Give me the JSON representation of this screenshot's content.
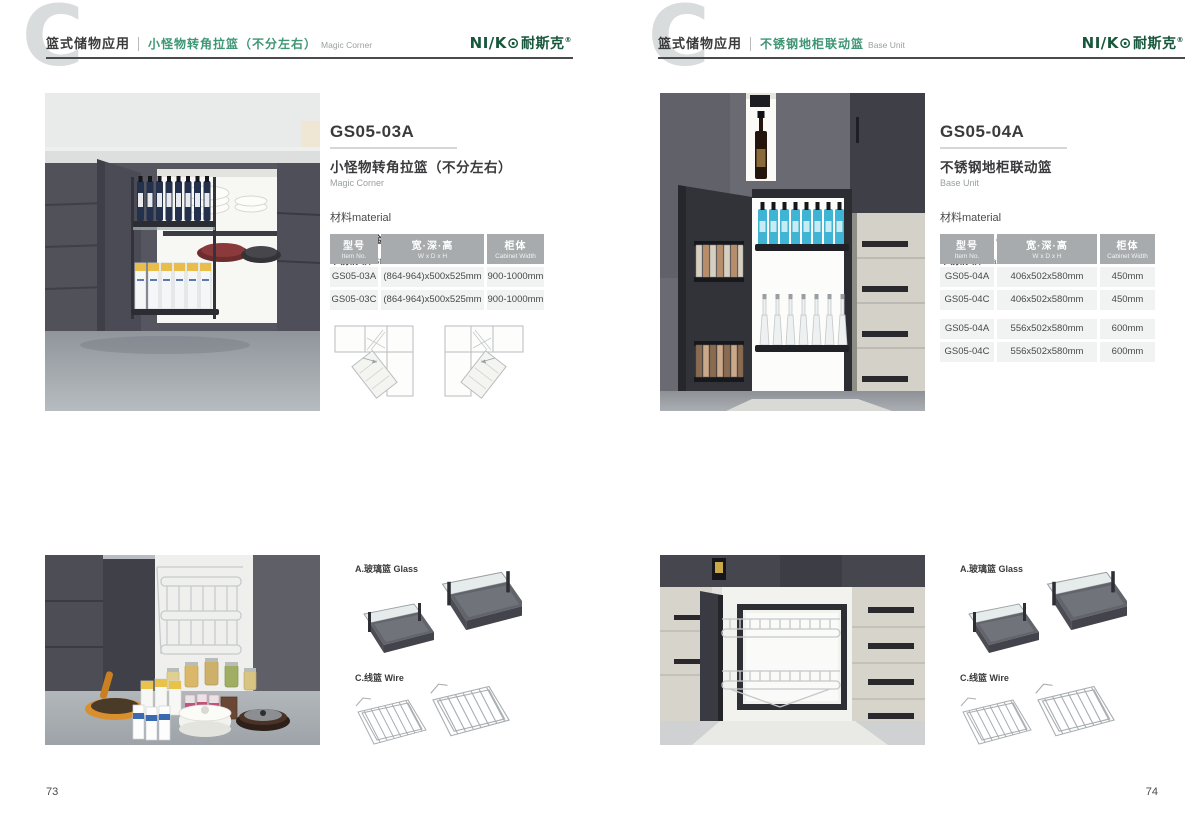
{
  "brand": {
    "latin": "NI/K",
    "o_glyph": "⊙",
    "cn": "耐斯克",
    "registered": "®"
  },
  "watermark_letter": "C",
  "pages": [
    {
      "page_number": "73",
      "header": {
        "category": "篮式储物应用",
        "title_cn": "小怪物转角拉篮（不分左右）",
        "title_en": "Magic Corner"
      },
      "product": {
        "model": "GS05-03A",
        "name_cn": "小怪物转角拉篮（不分左右）",
        "name_en": "Magic Corner",
        "material_label": "材料material",
        "materials": [
          {
            "cn": "玻璃+铝合金",
            "en": "Glass+Aluminum"
          },
          {
            "cn": "不锈钢/铁",
            "en": "Stainless SteeL/Iron"
          }
        ]
      },
      "table": {
        "headers": [
          {
            "cn": "型号",
            "en": "Item No."
          },
          {
            "cn": "宽·深·高",
            "en": "W x D x H"
          },
          {
            "cn": "柜体",
            "en": "Cabinet Width"
          }
        ],
        "rows": [
          [
            "GS05-03A",
            "(864-964)x500x525mm",
            "900-1000mm"
          ],
          [
            "GS05-03C",
            "(864-964)x500x525mm",
            "900-1000mm"
          ]
        ]
      },
      "accessories": [
        {
          "label": "A.玻璃篮 Glass"
        },
        {
          "label": "C.线篮 Wire"
        }
      ]
    },
    {
      "page_number": "74",
      "header": {
        "category": "篮式储物应用",
        "title_cn": "不锈钢地柜联动篮",
        "title_en": "Base Unit"
      },
      "product": {
        "model": "GS05-04A",
        "name_cn": "不锈钢地柜联动篮",
        "name_en": "Base Unit",
        "material_label": "材料material",
        "materials": [
          {
            "cn": "玻璃+铝合金",
            "en": "Glass+Aluminum"
          },
          {
            "cn": "不锈钢/铁",
            "en": "Stainless SteeL/Iron"
          }
        ]
      },
      "table": {
        "headers": [
          {
            "cn": "型号",
            "en": "Item No."
          },
          {
            "cn": "宽·深·高",
            "en": "W x D x H"
          },
          {
            "cn": "柜体",
            "en": "Cabinet Width"
          }
        ],
        "rows": [
          [
            "GS05-04A",
            "406x502x580mm",
            "450mm"
          ],
          [
            "GS05-04C",
            "406x502x580mm",
            "450mm"
          ],
          [
            "GS05-04A",
            "556x502x580mm",
            "600mm"
          ],
          [
            "GS05-04C",
            "556x502x580mm",
            "600mm"
          ]
        ]
      },
      "accessories": [
        {
          "label": "A.玻璃篮 Glass"
        },
        {
          "label": "C.线篮 Wire"
        }
      ]
    }
  ],
  "colors": {
    "accent_green": "#3f9674",
    "logo_green": "#17573c",
    "table_header_bg": "#a7abad",
    "table_row_bg": "#f1f2f2",
    "text_dark": "#3a3a3c",
    "watermark_grey": "#d9dcdc"
  }
}
